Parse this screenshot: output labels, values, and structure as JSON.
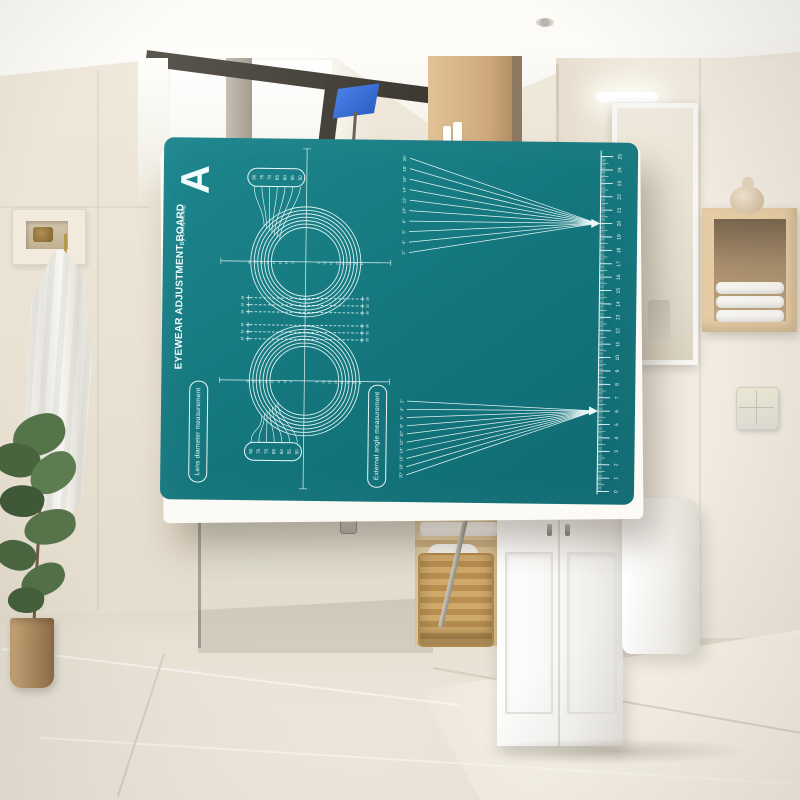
{
  "board": {
    "letter": "A",
    "title": "EYEWEAR ADJUSTMENT BOARD",
    "brand": "By Dhoptical®",
    "left_pill_label": "Lens diameter measurement",
    "right_pill_label": "External angle measurement",
    "lens_diameters_mm": [
      "80",
      "75",
      "70",
      "65",
      "60",
      "55",
      "50"
    ],
    "axis_mm_labels": [
      "5",
      "10",
      "15",
      "20",
      "25",
      "30",
      "35",
      "40"
    ],
    "bridge_width_labels": [
      "28",
      "32",
      "36"
    ],
    "angle_labels": [
      "2°",
      "4°",
      "6°",
      "8°",
      "10°",
      "12°",
      "14°",
      "16°",
      "18°",
      "20°"
    ],
    "ruler_numbers": [
      "0",
      "1",
      "2",
      "3",
      "4",
      "5",
      "6",
      "7",
      "8",
      "9",
      "10",
      "11",
      "12",
      "13",
      "14",
      "15",
      "16",
      "17",
      "18",
      "19",
      "20",
      "21",
      "22",
      "23",
      "24",
      "25"
    ],
    "colors": {
      "board_teal": "#14757c",
      "line_white": "#ecf9f8",
      "flag_blue": "#2f6bd9"
    }
  }
}
